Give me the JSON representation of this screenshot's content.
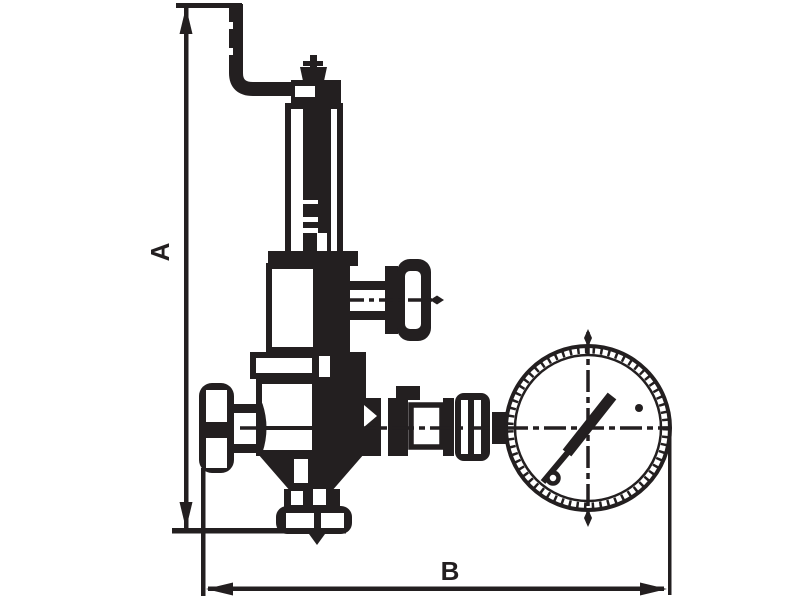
{
  "page": {
    "background_color": "#ffffff"
  },
  "drawing": {
    "kind": "valve-technical-drawing",
    "ink_color": "#231f20",
    "dimension_a": {
      "label": "A",
      "orientation": "vertical"
    },
    "dimension_b": {
      "label": "B",
      "orientation": "horizontal"
    },
    "parts": [
      {
        "name": "lever-handle"
      },
      {
        "name": "cap-nut"
      },
      {
        "name": "spring-housing"
      },
      {
        "name": "bonnet"
      },
      {
        "name": "side-knob"
      },
      {
        "name": "upper-flange"
      },
      {
        "name": "valve-body"
      },
      {
        "name": "handwheel"
      },
      {
        "name": "outlet-union"
      },
      {
        "name": "pressure-gauge"
      },
      {
        "name": "gauge-needle"
      },
      {
        "name": "bottom-flange"
      }
    ]
  }
}
